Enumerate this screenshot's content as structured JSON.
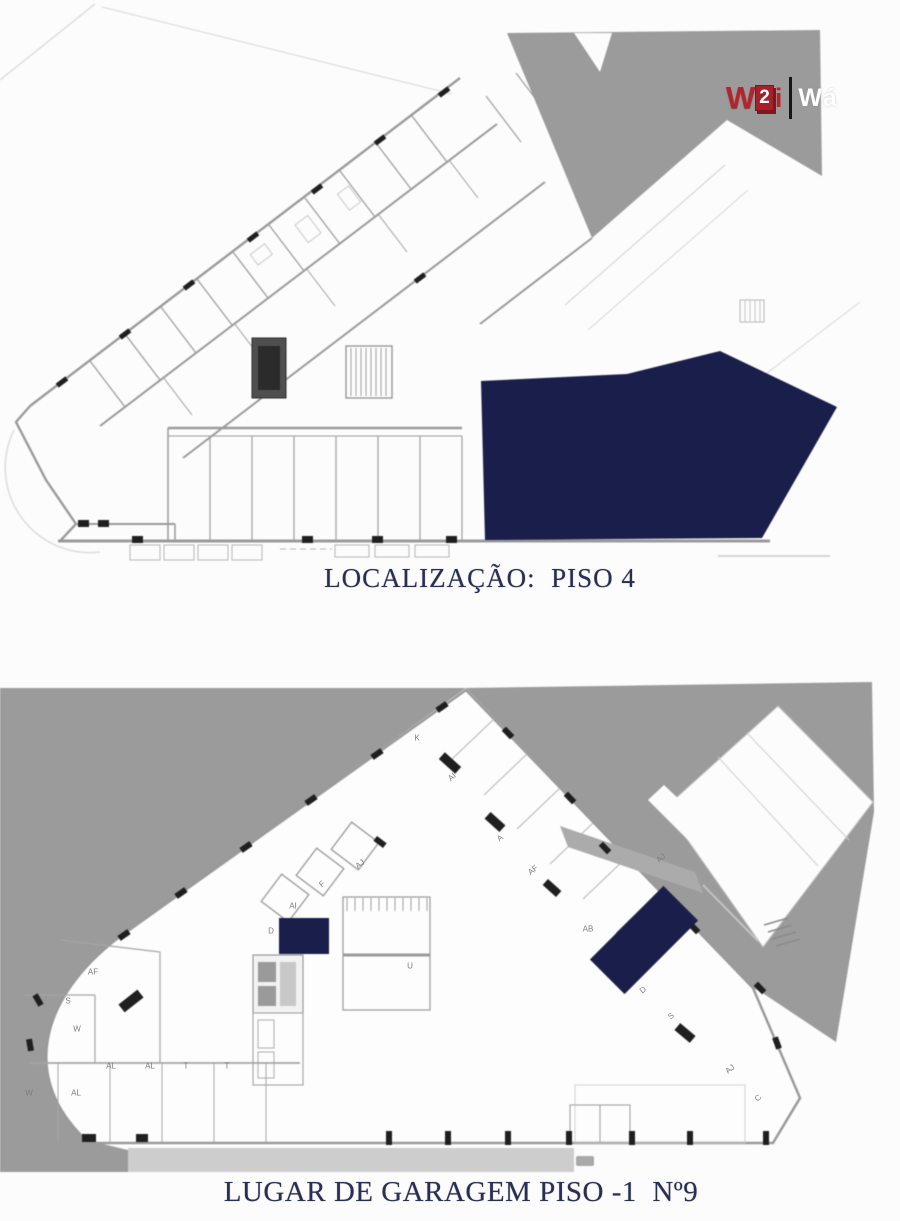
{
  "page": {
    "width": 900,
    "height": 1221,
    "background": "#fcfcfc"
  },
  "logo": {
    "mark_w": "W",
    "mark_2": "2",
    "mark_i": "i",
    "wordmark": "Wá"
  },
  "colors": {
    "navy_highlight": "#1a1e4a",
    "plan_gray": "#9b9b9b",
    "light_gray": "#cdcdcd",
    "wall_gray": "#9a9a9a",
    "pillar_black": "#1f1f1f",
    "caption_navy": "#2a2e52",
    "logo_red": "#b5242b",
    "label_gray": "#7d7d7d"
  },
  "floor_plan": {
    "caption": "LOCALIZAÇÃO:  PISO 4"
  },
  "garage_plan": {
    "caption": "LUGAR DE GARAGEM PISO -1  Nº9",
    "space_labels": [
      {
        "t": "K",
        "x": 417,
        "y": 738,
        "r": 0
      },
      {
        "t": "AI",
        "x": 452,
        "y": 777,
        "r": -40
      },
      {
        "t": "A",
        "x": 500,
        "y": 838,
        "r": -40
      },
      {
        "t": "AF",
        "x": 533,
        "y": 870,
        "r": -40
      },
      {
        "t": "AJ",
        "x": 661,
        "y": 858,
        "r": -40
      },
      {
        "t": "AB",
        "x": 588,
        "y": 929,
        "r": 0
      },
      {
        "t": "D",
        "x": 643,
        "y": 990,
        "r": -40
      },
      {
        "t": "S",
        "x": 671,
        "y": 1016,
        "r": -40
      },
      {
        "t": "AJ",
        "x": 360,
        "y": 864,
        "r": -38
      },
      {
        "t": "F",
        "x": 322,
        "y": 884,
        "r": -38
      },
      {
        "t": "AI",
        "x": 293,
        "y": 906,
        "r": 0
      },
      {
        "t": "D",
        "x": 271,
        "y": 931,
        "r": 0
      },
      {
        "t": "U",
        "x": 410,
        "y": 966,
        "r": 0
      },
      {
        "t": "AF",
        "x": 93,
        "y": 972,
        "r": 0
      },
      {
        "t": "S",
        "x": 68,
        "y": 1001,
        "r": 0
      },
      {
        "t": "W",
        "x": 77,
        "y": 1029,
        "r": 0
      },
      {
        "t": "AL",
        "x": 111,
        "y": 1066,
        "r": 0
      },
      {
        "t": "AL",
        "x": 150,
        "y": 1066,
        "r": 0
      },
      {
        "t": "T",
        "x": 186,
        "y": 1066,
        "r": 0
      },
      {
        "t": "T",
        "x": 227,
        "y": 1066,
        "r": 0
      },
      {
        "t": "W",
        "x": 29,
        "y": 1093,
        "r": 0
      },
      {
        "t": "AL",
        "x": 76,
        "y": 1093,
        "r": 0
      },
      {
        "t": "AJ",
        "x": 730,
        "y": 1069,
        "r": -40
      },
      {
        "t": "C",
        "x": 758,
        "y": 1098,
        "r": -40
      }
    ]
  }
}
